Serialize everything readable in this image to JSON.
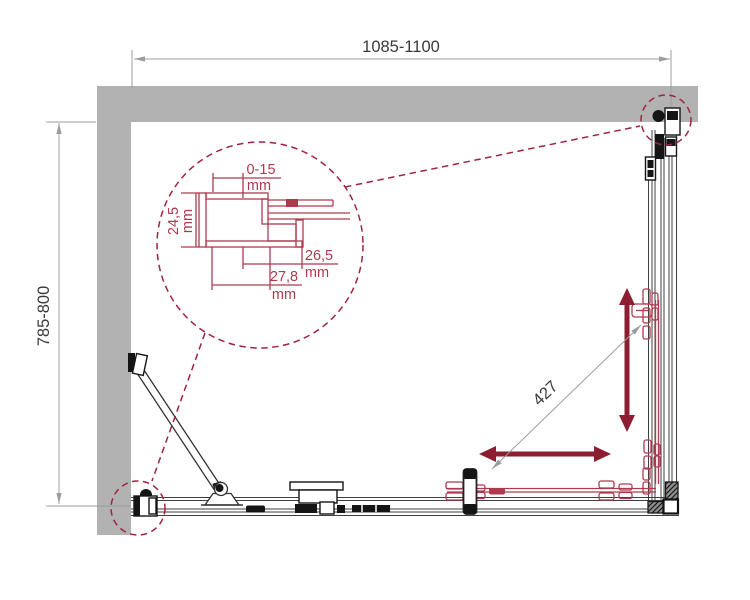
{
  "drawing": {
    "type": "shower-enclosure-plan-view",
    "dimensions": {
      "width_label": "1085-1100",
      "depth_label": "785-800",
      "diagonal_label": "427"
    },
    "detail": {
      "unit": "mm",
      "adjust_range": "0-15",
      "profile_height": "24,5",
      "inner_width": "26,5",
      "outer_width": "27,8"
    },
    "colors": {
      "wall": "#b2b2b2",
      "accent": "#8e1d32",
      "detail": "#ae3a4e",
      "dashed": "#a02440",
      "line": "#3f3f3f",
      "dim": "#9c9c9c",
      "text": "#3a3a3a"
    }
  }
}
